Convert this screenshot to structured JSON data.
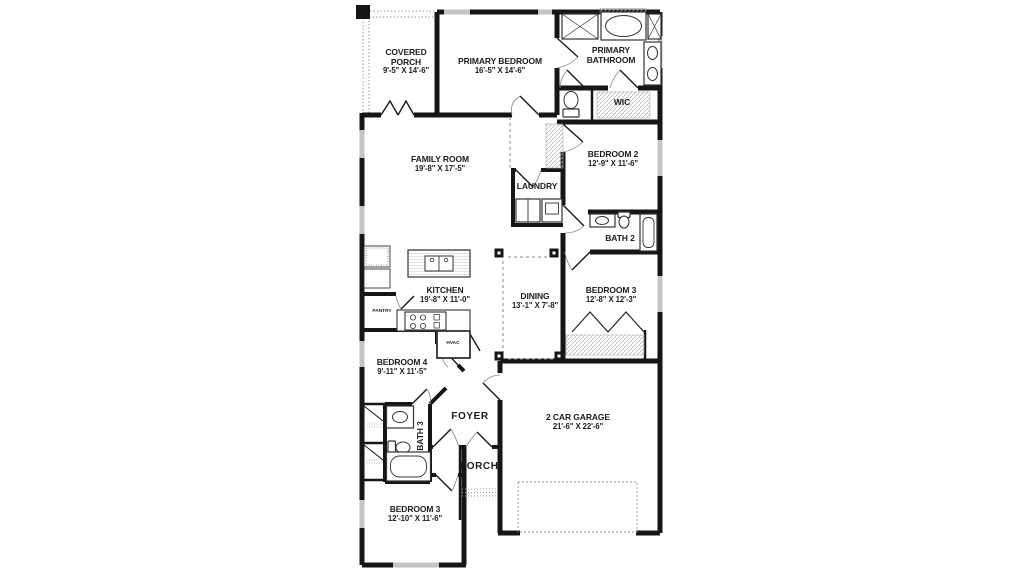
{
  "plan_title": "Single-story floor plan",
  "colors": {
    "wall": "#161616",
    "window": "#c4c4c4",
    "hatch": "#b0b0b0",
    "dash": "#8a8a8a",
    "text": "#1d1d1d",
    "background": "#ffffff"
  },
  "rooms": [
    {
      "name": "COVERED PORCH",
      "dims": "9'-5\" X 14'-6\""
    },
    {
      "name": "PRIMARY BEDROOM",
      "dims": "16'-5\" X 14'-6\""
    },
    {
      "name": "PRIMARY BATHROOM",
      "dims": ""
    },
    {
      "name": "WIC",
      "dims": ""
    },
    {
      "name": "BEDROOM 2",
      "dims": "12'-9\" X 11'-6\""
    },
    {
      "name": "FAMILY ROOM",
      "dims": "19'-8\" X 17'-5\""
    },
    {
      "name": "LAUNDRY",
      "dims": ""
    },
    {
      "name": "BATH 2",
      "dims": ""
    },
    {
      "name": "KITCHEN",
      "dims": "19'-8\" X 11'-0\""
    },
    {
      "name": "PANTRY",
      "dims": ""
    },
    {
      "name": "DINING",
      "dims": "13'-1\" X 7'-8\""
    },
    {
      "name": "BEDROOM 3",
      "dims": "12'-8\" X 12'-3\""
    },
    {
      "name": "HVAC",
      "dims": ""
    },
    {
      "name": "BEDROOM 4",
      "dims": "9'-11\" X 11'-5\""
    },
    {
      "name": "FOYER",
      "dims": ""
    },
    {
      "name": "BATH 3",
      "dims": ""
    },
    {
      "name": "PORCH",
      "dims": ""
    },
    {
      "name": "2 CAR GARAGE",
      "dims": "21'-6\" X 22'-6\""
    },
    {
      "name": "BEDROOM 3",
      "dims": "12'-10\" X 11'-6\""
    }
  ]
}
